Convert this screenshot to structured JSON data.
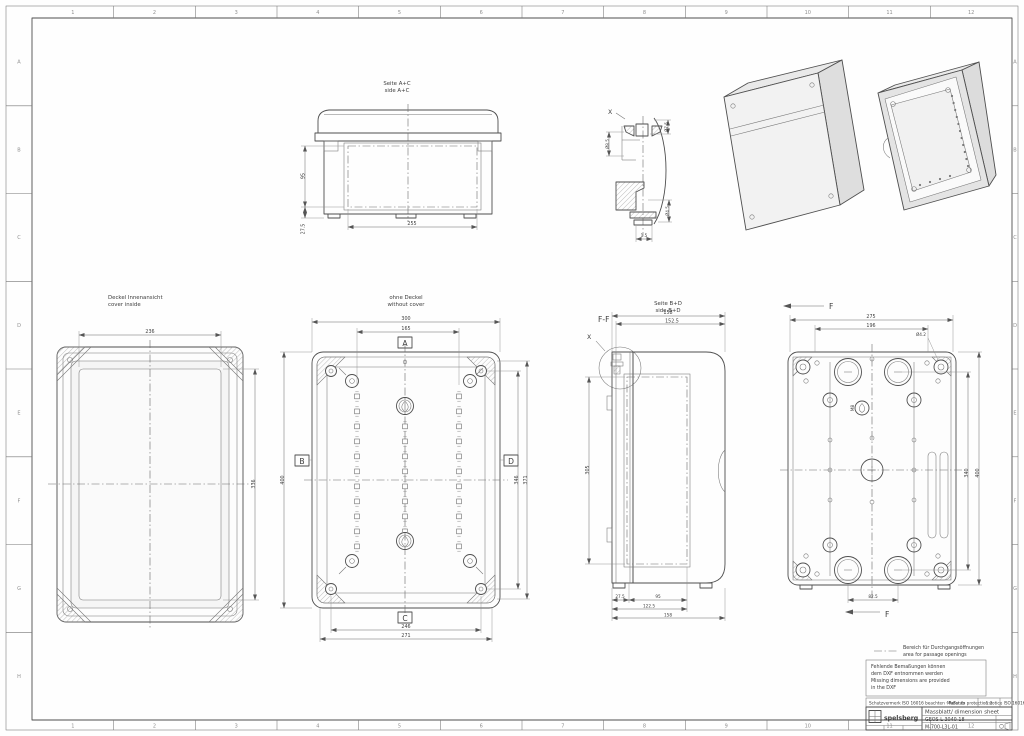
{
  "frame": {
    "cols": [
      "1",
      "2",
      "3",
      "4",
      "5",
      "6",
      "7",
      "8",
      "9",
      "10",
      "11",
      "12"
    ],
    "rows": [
      "A",
      "B",
      "C",
      "D",
      "E",
      "F",
      "G",
      "H"
    ]
  },
  "views": {
    "side_ac": {
      "label_de": "Seite A+C",
      "label_en": "side A+C",
      "dim_height": "95",
      "dim_offset": "27.5",
      "dim_width": "255"
    },
    "detail_x": {
      "label": "X",
      "dim_top": "Ø7.5",
      "dim_left": "Ø8.5",
      "dim_right": "Ø4.5",
      "dim_bottom": "1.5"
    },
    "cover": {
      "label_de": "Deckel Innenansicht",
      "label_en": "cover inside",
      "dim_width": "236",
      "dim_height": "336"
    },
    "open_box": {
      "label_de": "ohne Deckel",
      "label_en": "without cover",
      "mark_a": "A",
      "mark_b": "B",
      "mark_c": "C",
      "mark_d": "D",
      "dim_w_outer": "300",
      "dim_w_inner": "165",
      "dim_screw_w": "246",
      "dim_w_base": "271",
      "dim_h_outer": "400",
      "dim_screw_h": "346",
      "dim_h_inner": "371"
    },
    "side_bd": {
      "label_de": "Seite B+D",
      "label_en": "side B+D",
      "section_label": "F-F",
      "detail_label": "X",
      "dim_top_outer": "158",
      "dim_top_inner": "152.5",
      "dim_opening": "305",
      "dim_b1": "27.5",
      "dim_b2": "95",
      "dim_b3": "122.5",
      "dim_b4": "158"
    },
    "back": {
      "mark": "F",
      "dim_w_outer": "275",
      "dim_w_inner": "196",
      "dim_hole": "Ø4.2",
      "dim_thread": "M8",
      "dim_v_inner": "340",
      "dim_v_outer": "400",
      "dim_bottom": "82.5"
    }
  },
  "legend": {
    "text_de": "Bereich für Durchgangsöffnungen",
    "text_en": "area for passage openings"
  },
  "notes": {
    "lines": [
      "Fehlende Bemaßungen können",
      "dem DXF entnommen werden",
      "Missing dimensions are provided",
      "in the DXF"
    ]
  },
  "title_block": {
    "protection_note": "Schutzvermerk ISO 16016 beachten · Refer to protection notice ISO 16016",
    "scale_label": "Maßstab",
    "scale_value": "1:2",
    "brand": "spelsberg",
    "doc_type": "Massblatt/ dimension sheet",
    "part_no": "GEOS-L 3040-18",
    "drawing_no": "M-700-L3L-01"
  }
}
